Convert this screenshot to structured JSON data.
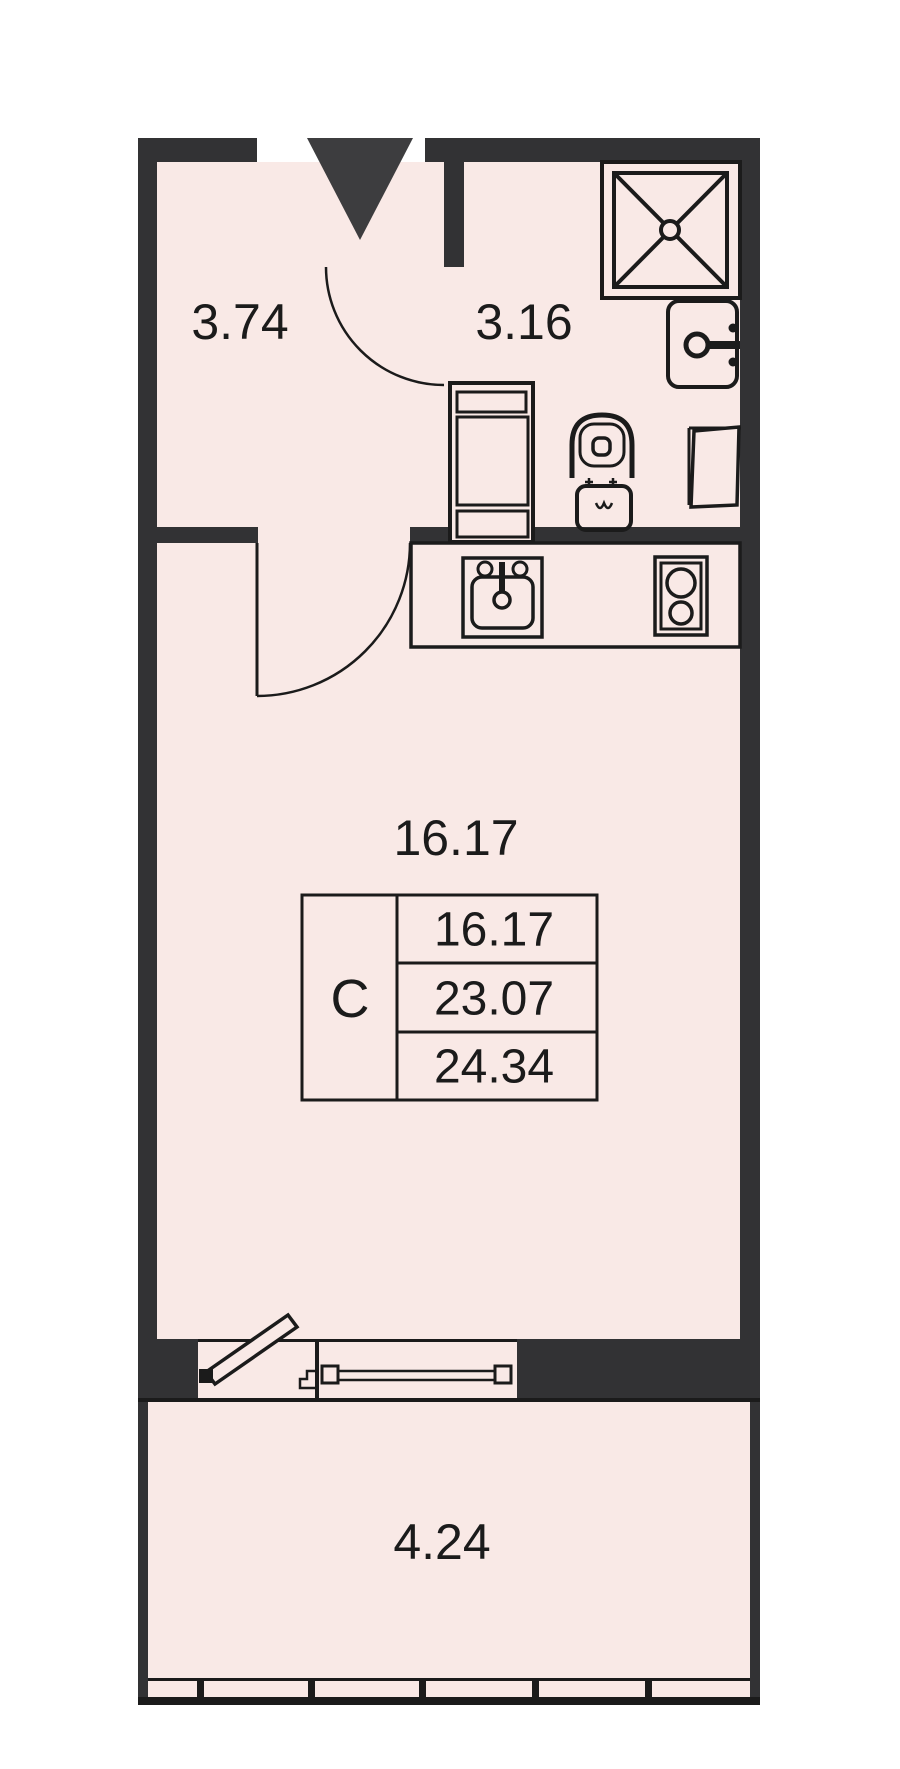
{
  "title": "Studio apartment floor plan",
  "rooms": {
    "hallway": {
      "area": "3.74"
    },
    "bathroom": {
      "area": "3.16"
    },
    "living_room": {
      "area": "16.17"
    },
    "balcony": {
      "area": "4.24"
    }
  },
  "area_table": {
    "type_label": "C",
    "living_area": "16.17",
    "area_without_balcony": "23.07",
    "total_area": "24.34"
  },
  "colors": {
    "wall": "#323234",
    "entrance_marker": "#3d3d3f",
    "floor": "#f9e9e6",
    "line": "#1b1b1b",
    "background": "#ffffff"
  }
}
